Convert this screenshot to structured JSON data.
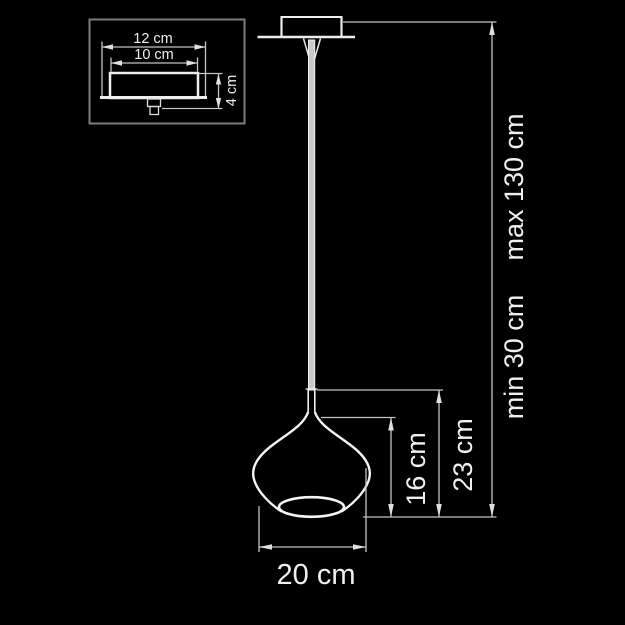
{
  "diagram": {
    "type": "pendant-lamp-technical-drawing",
    "colors": {
      "background": "#000000",
      "line": "#ededed",
      "dimension_line": "#c4c4c4",
      "text": "#f0f0f0",
      "inset_border": "#7d7d7d",
      "cord_fill": "#c9c9c9"
    },
    "inset": {
      "description": "canopy-detail-side-view",
      "labels": {
        "outer_width": "12 cm",
        "inner_width": "10 cm",
        "height": "4 cm"
      }
    },
    "main": {
      "labels": {
        "shade_diameter": "20 cm",
        "shade_body_height": "16 cm",
        "shade_total_height": "23 cm",
        "suspension_min": "min 30 cm",
        "suspension_max": "max 130 cm"
      }
    },
    "dimensions_cm": {
      "canopy_outer_width": 12,
      "canopy_inner_width": 10,
      "canopy_height": 4,
      "shade_diameter": 20,
      "shade_body_height": 16,
      "shade_total_height": 23,
      "suspension_min": 30,
      "suspension_max": 130
    }
  }
}
